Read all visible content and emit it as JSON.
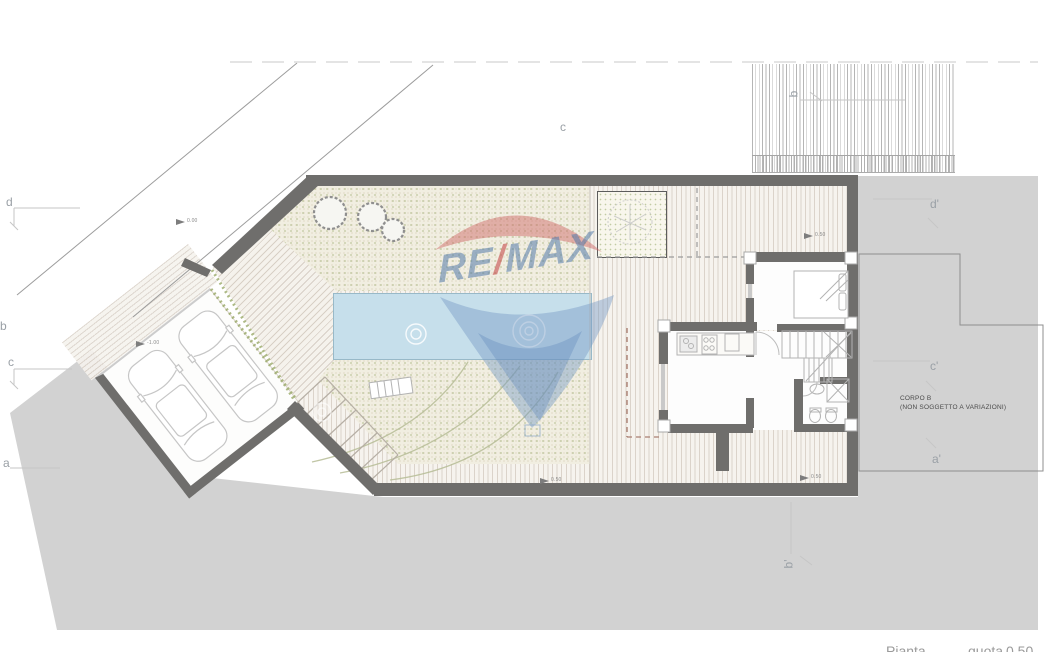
{
  "caption": {
    "left": "Pianta",
    "middle": "quota",
    "right": "0.50"
  },
  "watermark": {
    "re": "RE",
    "slash": "/",
    "max": "MAX"
  },
  "notes": {
    "corpo_b_title": "CORPO B",
    "corpo_b_subtitle": "(NON SOGGETTO A VARIAZIONI)"
  },
  "section_markers": {
    "left": [
      "d",
      "b",
      "c",
      "a"
    ],
    "top": [
      "c",
      "b"
    ],
    "right": [
      "d'",
      "c'",
      "a'"
    ],
    "bottom": [
      "b'"
    ]
  },
  "elevation_markers": [
    "0.00",
    "-1.00",
    "0.50",
    "0.50",
    "0.50"
  ],
  "colors": {
    "terrain_gray": "#d2d2d2",
    "wall_gray": "#6f6e6c",
    "pool_blue": "#c6dfeb",
    "garden_green": "#8ca05a",
    "deck_beige": "#f6f3ee",
    "watermark_blue": "#527aaa",
    "watermark_red": "#c64d4d"
  }
}
